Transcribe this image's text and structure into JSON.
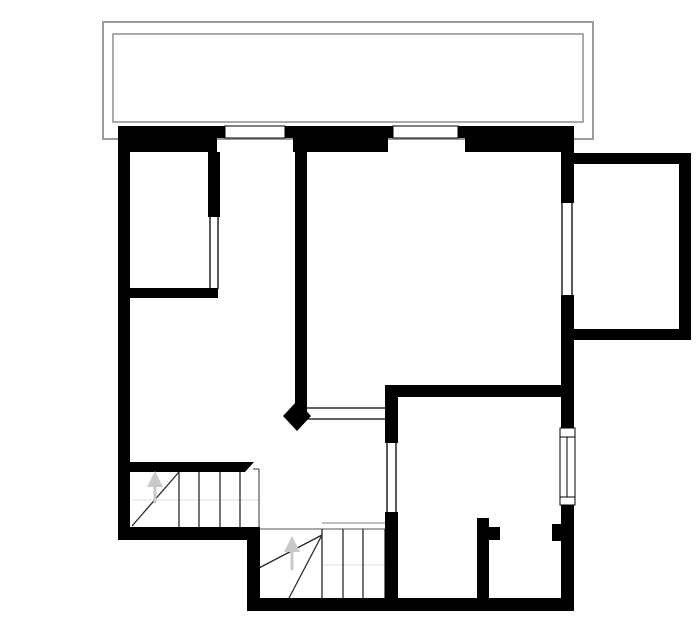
{
  "drawing": {
    "kind": "floor-plan",
    "canvas": {
      "width": 700,
      "height": 644,
      "background": "#ffffff"
    },
    "palette": {
      "wall": "#000000",
      "balcony_outer": "#9b9b9b",
      "balcony_inner": "#8d8d8d",
      "stair_line": "#2a2a2a",
      "stair_edge": "#555555",
      "stair_light": "#999999",
      "stair_faint": "#dcdcdc",
      "arrow": "#c9c9c9",
      "window_fill": "#ffffff",
      "window_stroke": "#000000"
    },
    "balcony": {
      "outer": {
        "name": "balcony-outline-outer",
        "x": 103,
        "y": 22,
        "w": 490,
        "h": 117,
        "stroke": "#9b9b9b",
        "sw": 2
      },
      "inner": {
        "name": "balcony-outline-inner",
        "x": 113,
        "y": 34,
        "w": 470,
        "h": 88,
        "stroke": "#8d8d8d",
        "sw": 1.5
      }
    },
    "walls": [
      {
        "name": "top-wall-upper-left",
        "x": 118,
        "y": 126,
        "w": 107,
        "h": 12
      },
      {
        "name": "top-wall-upper-middle",
        "x": 285,
        "y": 126,
        "w": 108,
        "h": 12
      },
      {
        "name": "top-wall-upper-right",
        "x": 458,
        "y": 126,
        "w": 116,
        "h": 12
      },
      {
        "name": "top-wall-lower-left",
        "x": 118,
        "y": 138,
        "w": 99,
        "h": 14
      },
      {
        "name": "top-wall-lower-middle",
        "x": 293,
        "y": 138,
        "w": 95,
        "h": 14
      },
      {
        "name": "top-wall-lower-right",
        "x": 465,
        "y": 138,
        "w": 109,
        "h": 14
      },
      {
        "name": "left-exterior-wall",
        "x": 118,
        "y": 126,
        "w": 12,
        "h": 414
      },
      {
        "name": "room1-right-wall",
        "x": 208,
        "y": 152,
        "w": 12,
        "h": 65
      },
      {
        "name": "room1-bottom-wall",
        "x": 130,
        "y": 288,
        "w": 88,
        "h": 10
      },
      {
        "name": "middle-partition-wall",
        "x": 295,
        "y": 152,
        "w": 12,
        "h": 262
      },
      {
        "name": "bottomright-room-top-wall",
        "x": 385,
        "y": 385,
        "w": 177,
        "h": 12
      },
      {
        "name": "bottomright-room-left-wall-upper",
        "x": 385,
        "y": 385,
        "w": 13,
        "h": 58
      },
      {
        "name": "bottomright-room-left-wall-lower",
        "x": 385,
        "y": 512,
        "w": 13,
        "h": 99
      },
      {
        "name": "closet-stub-wall",
        "x": 477,
        "y": 518,
        "w": 12,
        "h": 85
      },
      {
        "name": "closet-stub-jamb",
        "x": 489,
        "y": 527,
        "w": 11,
        "h": 13
      },
      {
        "name": "right-wall-jamb",
        "x": 552,
        "y": 524,
        "w": 10,
        "h": 17
      },
      {
        "name": "right-exterior-wall-top",
        "x": 561,
        "y": 126,
        "w": 13,
        "h": 77
      },
      {
        "name": "right-exterior-wall-mid",
        "x": 561,
        "y": 295,
        "w": 13,
        "h": 133
      },
      {
        "name": "right-exterior-wall-low",
        "x": 561,
        "y": 505,
        "w": 13,
        "h": 106
      },
      {
        "name": "bottom-wall-left",
        "x": 118,
        "y": 527,
        "w": 142,
        "h": 13
      },
      {
        "name": "step-wall",
        "x": 247,
        "y": 533,
        "w": 13,
        "h": 70
      },
      {
        "name": "bottom-wall-right",
        "x": 247,
        "y": 598,
        "w": 327,
        "h": 13
      },
      {
        "name": "stair1-top-wall",
        "x": 130,
        "y": 462,
        "w": 115,
        "h": 10
      },
      {
        "name": "annex-top-wall",
        "x": 573,
        "y": 153,
        "w": 118,
        "h": 11
      },
      {
        "name": "annex-right-wall",
        "x": 679,
        "y": 153,
        "w": 12,
        "h": 187
      },
      {
        "name": "annex-bottom-wall",
        "x": 573,
        "y": 329,
        "w": 118,
        "h": 11
      }
    ],
    "polygons": [
      {
        "name": "stair1-wall-chamfer",
        "points": "245,462 254,462 245,472"
      },
      {
        "name": "middle-wall-end-cap",
        "points": "297,401 311,416 297,431 283,416"
      }
    ],
    "windows": [
      {
        "name": "window-top-1",
        "x": 225,
        "y": 126,
        "w": 60,
        "h": 12,
        "lines": []
      },
      {
        "name": "window-top-2",
        "x": 393,
        "y": 126,
        "w": 65,
        "h": 12,
        "lines": []
      },
      {
        "name": "window-right",
        "x": 560,
        "y": 428,
        "w": 15,
        "h": 77,
        "lines": [
          {
            "x1": 560,
            "y1": 437,
            "x2": 575,
            "y2": 437
          },
          {
            "x1": 560,
            "y1": 497,
            "x2": 575,
            "y2": 497
          },
          {
            "x1": 567,
            "y1": 437,
            "x2": 567,
            "y2": 497
          }
        ]
      }
    ],
    "openings": [
      {
        "name": "room1-door-opening-a",
        "x1": 210,
        "y1": 217,
        "x2": 210,
        "y2": 289,
        "c": "#000000",
        "w": 1.3
      },
      {
        "name": "room1-door-opening-b",
        "x1": 218,
        "y1": 217,
        "x2": 218,
        "y2": 289,
        "c": "#000000",
        "w": 1.3
      },
      {
        "name": "hall-passage-opening-a",
        "x1": 307,
        "y1": 408,
        "x2": 385,
        "y2": 408,
        "c": "#000000",
        "w": 1.3
      },
      {
        "name": "hall-passage-opening-b",
        "x1": 307,
        "y1": 419,
        "x2": 385,
        "y2": 419,
        "c": "#000000",
        "w": 1.3
      },
      {
        "name": "bottomright-door-opening-a",
        "x1": 387,
        "y1": 443,
        "x2": 387,
        "y2": 512,
        "c": "#000000",
        "w": 1.3
      },
      {
        "name": "bottomright-door-opening-b",
        "x1": 396,
        "y1": 443,
        "x2": 396,
        "y2": 512,
        "c": "#000000",
        "w": 1.3
      },
      {
        "name": "right-wall-opening-a",
        "x1": 562,
        "y1": 203,
        "x2": 562,
        "y2": 295,
        "c": "#000000",
        "w": 1.3
      },
      {
        "name": "right-wall-opening-b",
        "x1": 572,
        "y1": 203,
        "x2": 572,
        "y2": 295,
        "c": "#000000",
        "w": 1.3
      }
    ],
    "stair_lines": [
      {
        "name": "stair1-faint-line",
        "x1": 132,
        "y1": 500,
        "x2": 259,
        "y2": 500,
        "c": "#dcdcdc",
        "w": 1
      },
      {
        "name": "stair1-tread-1",
        "x1": 179,
        "y1": 472,
        "x2": 179,
        "y2": 527,
        "c": "#2a2a2a",
        "w": 1.3
      },
      {
        "name": "stair1-tread-2",
        "x1": 199,
        "y1": 472,
        "x2": 199,
        "y2": 527,
        "c": "#2a2a2a",
        "w": 1.3
      },
      {
        "name": "stair1-tread-3",
        "x1": 220,
        "y1": 472,
        "x2": 220,
        "y2": 527,
        "c": "#2a2a2a",
        "w": 1.3
      },
      {
        "name": "stair1-tread-4",
        "x1": 240,
        "y1": 472,
        "x2": 240,
        "y2": 527,
        "c": "#2a2a2a",
        "w": 1.3
      },
      {
        "name": "stair1-edge-top",
        "x1": 253,
        "y1": 469,
        "x2": 259,
        "y2": 469,
        "c": "#555555",
        "w": 1.2
      },
      {
        "name": "stair1-edge-right",
        "x1": 259,
        "y1": 469,
        "x2": 259,
        "y2": 527,
        "c": "#555555",
        "w": 1.2
      },
      {
        "name": "stair1-winder-diagonal",
        "x1": 132,
        "y1": 526,
        "x2": 179,
        "y2": 472,
        "c": "#2a2a2a",
        "w": 1.3
      },
      {
        "name": "stair2-faint-line",
        "x1": 322,
        "y1": 565,
        "x2": 385,
        "y2": 565,
        "c": "#dcdcdc",
        "w": 1
      },
      {
        "name": "stair2-top-edge-a",
        "x1": 322,
        "y1": 523,
        "x2": 386,
        "y2": 523,
        "c": "#999999",
        "w": 1.2
      },
      {
        "name": "stair2-top-edge-b",
        "x1": 260,
        "y1": 529,
        "x2": 386,
        "y2": 529,
        "c": "#777777",
        "w": 1.3
      },
      {
        "name": "stair2-tread-1",
        "x1": 322,
        "y1": 529,
        "x2": 322,
        "y2": 598,
        "c": "#2a2a2a",
        "w": 1.3
      },
      {
        "name": "stair2-tread-2",
        "x1": 343,
        "y1": 529,
        "x2": 343,
        "y2": 598,
        "c": "#2a2a2a",
        "w": 1.3
      },
      {
        "name": "stair2-tread-3",
        "x1": 363,
        "y1": 529,
        "x2": 363,
        "y2": 598,
        "c": "#2a2a2a",
        "w": 1.3
      },
      {
        "name": "stair2-tread-4",
        "x1": 385,
        "y1": 529,
        "x2": 385,
        "y2": 598,
        "c": "#2a2a2a",
        "w": 1.3
      },
      {
        "name": "stair2-winder-fan-1",
        "x1": 322,
        "y1": 535,
        "x2": 259,
        "y2": 568,
        "c": "#2a2a2a",
        "w": 1.3
      },
      {
        "name": "stair2-winder-fan-2",
        "x1": 322,
        "y1": 535,
        "x2": 289,
        "y2": 598,
        "c": "#2a2a2a",
        "w": 1.3
      }
    ],
    "arrows": [
      {
        "name": "stair1-up-arrow",
        "shaft": {
          "x1": 155,
          "y1": 503,
          "x2": 155,
          "y2": 484
        },
        "head": "147,487 163,487 155,471",
        "c": "#c9c9c9"
      },
      {
        "name": "stair2-up-arrow",
        "shaft": {
          "x1": 292,
          "y1": 570,
          "x2": 292,
          "y2": 549
        },
        "head": "284,552 300,552 292,536",
        "c": "#c9c9c9"
      }
    ]
  }
}
